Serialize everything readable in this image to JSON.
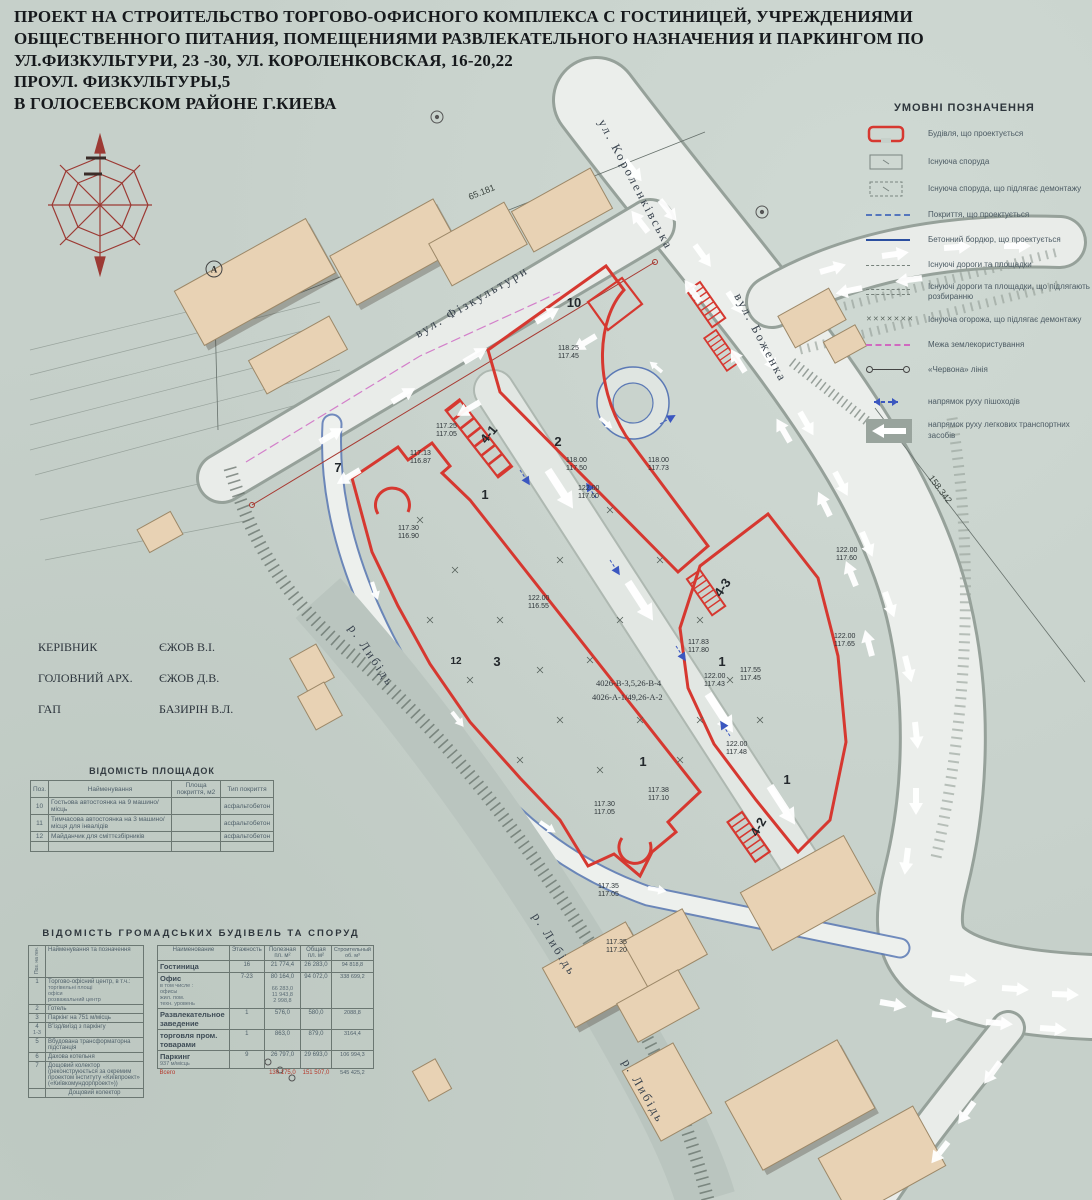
{
  "title": {
    "line1": "ПРОЕКТ НА СТРОИТЕЛЬСТВО ТОРГОВО-ОФИСНОГО  КОМПЛЕКСА С ГОСТИНИЦЕЙ, УЧРЕЖДЕНИЯМИ",
    "line2": "ОБЩЕСТВЕННОГО ПИТАНИЯ, ПОМЕЩЕНИЯМИ  РАЗВЛЕКАТЕЛЬНОГО НАЗНАЧЕНИЯ И ПАРКИНГОМ ПО",
    "line3": "УЛ.ФИЗКУЛЬТУРИ, 23 -30, УЛ. КОРОЛЕНКОВСКАЯ, 16-20,22",
    "line4": "ПРОУЛ. ФИЗКУЛЬТУРЫ,5",
    "line5": "В ГОЛОСЕЕВСКОМ  РАЙОНЕ Г.КИЕВА"
  },
  "legend": {
    "title": "УМОВНІ ПОЗНАЧЕННЯ",
    "items": [
      "Будівля, що проектується",
      "Існуюча споруда",
      "Існуюча споруда, що підлягає демонтажу",
      "Покриття, що проектується",
      "Бетонний бордюр, що проектується",
      "Існуючі дороги та площадки",
      "Існуючі дороги та площадки, що підлягають розбиранню",
      "Існуюча огорожа, що підлягає демонтажу",
      "Межа землекористування",
      "«Червона» лінія",
      "напрямок руху пішоходів",
      "напрямок руху легкових транспортних засобів"
    ],
    "fence_glyphs": "✕✕✕✕✕✕✕"
  },
  "personnel": [
    {
      "role": "КЕРІВНИК",
      "name": "ЄЖОВ В.І."
    },
    {
      "role": "ГОЛОВНИЙ АРХ.",
      "name": "ЄЖОВ Д.В."
    },
    {
      "role": "ГАП",
      "name": "БАЗИРІН В.Л."
    }
  ],
  "sites_table": {
    "title": "ВІДОМІСТЬ ПЛОЩАДОК",
    "headers": {
      "pos": "Поз.",
      "name": "Найменування",
      "area": "Площа покриття, м2",
      "type": "Тип покриття"
    },
    "rows": [
      {
        "pos": "10",
        "name": "Гостьова автостоянка на 9 машино/місць",
        "area": "",
        "type": "асфальтобетон"
      },
      {
        "pos": "11",
        "name": "Тимчасова автостоянка на 3 машино/місця для інвалідів",
        "area": "",
        "type": "асфальтобетон"
      },
      {
        "pos": "12",
        "name": "Майданчик для сміттєзбірників",
        "area": "",
        "type": "асфальтобетон"
      }
    ]
  },
  "buildings_table": {
    "title": "ВІДОМІСТЬ ГРОМАДСЬКИХ БУДІВЕЛЬ ТА СПОРУД",
    "left": {
      "h_pos": "Поз. на ген.",
      "h_name": "Найменування та позначення",
      "rows": [
        {
          "pos": "1",
          "name": "Торгово-офісний центр, в т.ч.:",
          "s1": "торгівельні площі",
          "s2": "офіси",
          "s3": "розважальний центр"
        },
        {
          "pos": "2",
          "name": "Готель"
        },
        {
          "pos": "3",
          "name": "Паркінг на 751 м/місць"
        },
        {
          "pos": "4",
          "pos_sub": "1-3",
          "name": "В’їзд/виїзд з паркінгу"
        },
        {
          "pos": "5",
          "name": "Вбудована трансформаторна підстанція"
        },
        {
          "pos": "6",
          "name": "Дахова котельня"
        },
        {
          "pos": "7",
          "name": "Дощовий колектор (реконструюється за окремим проектом інституту «Київпроект» («Київкомундорпроект»))"
        },
        {
          "pos": "",
          "name": "Дощовий колектор"
        }
      ]
    },
    "right": {
      "h_name": "Наименование",
      "h_fl": "Этажность",
      "h_u": "Полезная пл. м²",
      "h_t": "Общая пл. м²",
      "h_v": "Строительный об. м³",
      "rows": [
        {
          "name": "Гостиница",
          "fl": "16",
          "u": "21 774,4",
          "t": "26 283,0",
          "v": "94 818,8"
        },
        {
          "name": "Офис",
          "ns0": "в том числе :",
          "ns1": "офисы",
          "ns2": "жил. пом.",
          "ns3": "техн. уровень",
          "fl": "7-23",
          "u": "80 164,0",
          "us1": "66 283,0",
          "us2": "11 943,8",
          "us3": "2 998,8",
          "t": "94 072,0",
          "v": "338 699,2"
        },
        {
          "name": "Развлекательное заведение",
          "fl": "1",
          "u": "576,0",
          "t": "580,0",
          "v": "2088,8"
        },
        {
          "name": "торговля пром. товарами",
          "fl": "1",
          "u": "863,0",
          "t": "879,0",
          "v": "3164,4"
        },
        {
          "name": "Паркинг",
          "ns0": "937 м/місць",
          "fl": "9",
          "u": "26 797,0",
          "t": "29 693,0",
          "v": "106 994,3"
        },
        {
          "name": "Всего",
          "fl": "",
          "u": "130 175,0",
          "t": "151 507,0",
          "v": "545 425,2"
        }
      ]
    }
  },
  "map": {
    "streets": {
      "korolenkivska": "ул. Короленківська",
      "fizkultury": "вул. Фізкультури",
      "bozhenka": "вул. Боженка"
    },
    "river_label": "р. Либідь",
    "dims": {
      "d1": "65.181",
      "d2": "158.342"
    },
    "axis_a": "А",
    "labels": {
      "b1": "1",
      "b2": "2",
      "b3": "3",
      "b41": "4-1",
      "b42": "4-2",
      "b43": "4-3",
      "b7": "7",
      "b10": "10",
      "b12": "12"
    },
    "ann1": "4026-В-3,5,26-В-4",
    "ann2": "4026-А-1/49,26-А-2",
    "elevations": [
      {
        "a": "117.25",
        "b": "117.05"
      },
      {
        "a": "117.13",
        "b": "116.87"
      },
      {
        "a": "117.30",
        "b": "116.90"
      },
      {
        "a": "118.25",
        "b": "117.45"
      },
      {
        "a": "118.00",
        "b": "117.50"
      },
      {
        "a": "122.00",
        "b": "117.60"
      },
      {
        "a": "118.00",
        "b": "117.73"
      },
      {
        "a": "122.00",
        "b": "116.55"
      },
      {
        "a": "117.83",
        "b": "117.80"
      },
      {
        "a": "122.00",
        "b": "117.43"
      },
      {
        "a": "117.55",
        "b": "117.45"
      },
      {
        "a": "122.00",
        "b": "117.48"
      },
      {
        "a": "117.38",
        "b": "117.10"
      },
      {
        "a": "117.30",
        "b": "117.05"
      },
      {
        "a": "122.00",
        "b": "117.60"
      },
      {
        "a": "122.00",
        "b": "117.65"
      },
      {
        "a": "117.35",
        "b": "117.05"
      },
      {
        "a": "117.35",
        "b": "117.20"
      }
    ]
  }
}
